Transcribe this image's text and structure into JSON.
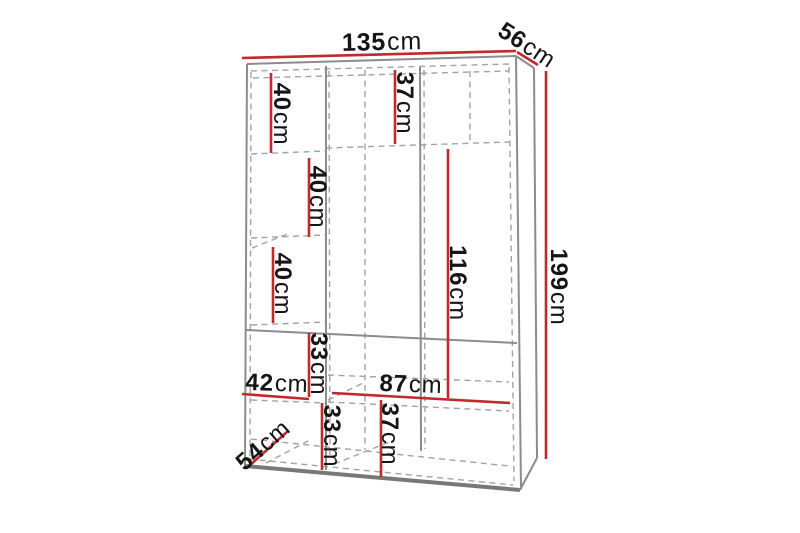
{
  "diagram": {
    "type": "furniture-dimension-diagram",
    "subject": "three-section wardrobe, perspective line drawing with shelf layout"
  },
  "colors": {
    "dimension_line": "#c1292b",
    "outline": "#8c8c8c",
    "outline_heavy": "#787878",
    "hidden_line": "#a3a3a3",
    "text": "#151515",
    "background": "#ffffff"
  },
  "dimensions": {
    "width": {
      "value": "135",
      "unit": "cm"
    },
    "depth": {
      "value": "56",
      "unit": "cm"
    },
    "height": {
      "value": "199",
      "unit": "cm"
    },
    "left_shelf_1": {
      "value": "40",
      "unit": "cm"
    },
    "top_shelf": {
      "value": "37",
      "unit": "cm"
    },
    "left_shelf_2": {
      "value": "40",
      "unit": "cm"
    },
    "left_shelf_3": {
      "value": "40",
      "unit": "cm"
    },
    "hanging_height": {
      "value": "116",
      "unit": "cm"
    },
    "mid_compartment": {
      "value": "33",
      "unit": "cm"
    },
    "left_width": {
      "value": "42",
      "unit": "cm"
    },
    "right_width": {
      "value": "87",
      "unit": "cm"
    },
    "bottom_left": {
      "value": "33",
      "unit": "cm"
    },
    "bottom_middle": {
      "value": "37",
      "unit": "cm"
    },
    "inner_depth": {
      "value": "54",
      "unit": "cm"
    }
  }
}
